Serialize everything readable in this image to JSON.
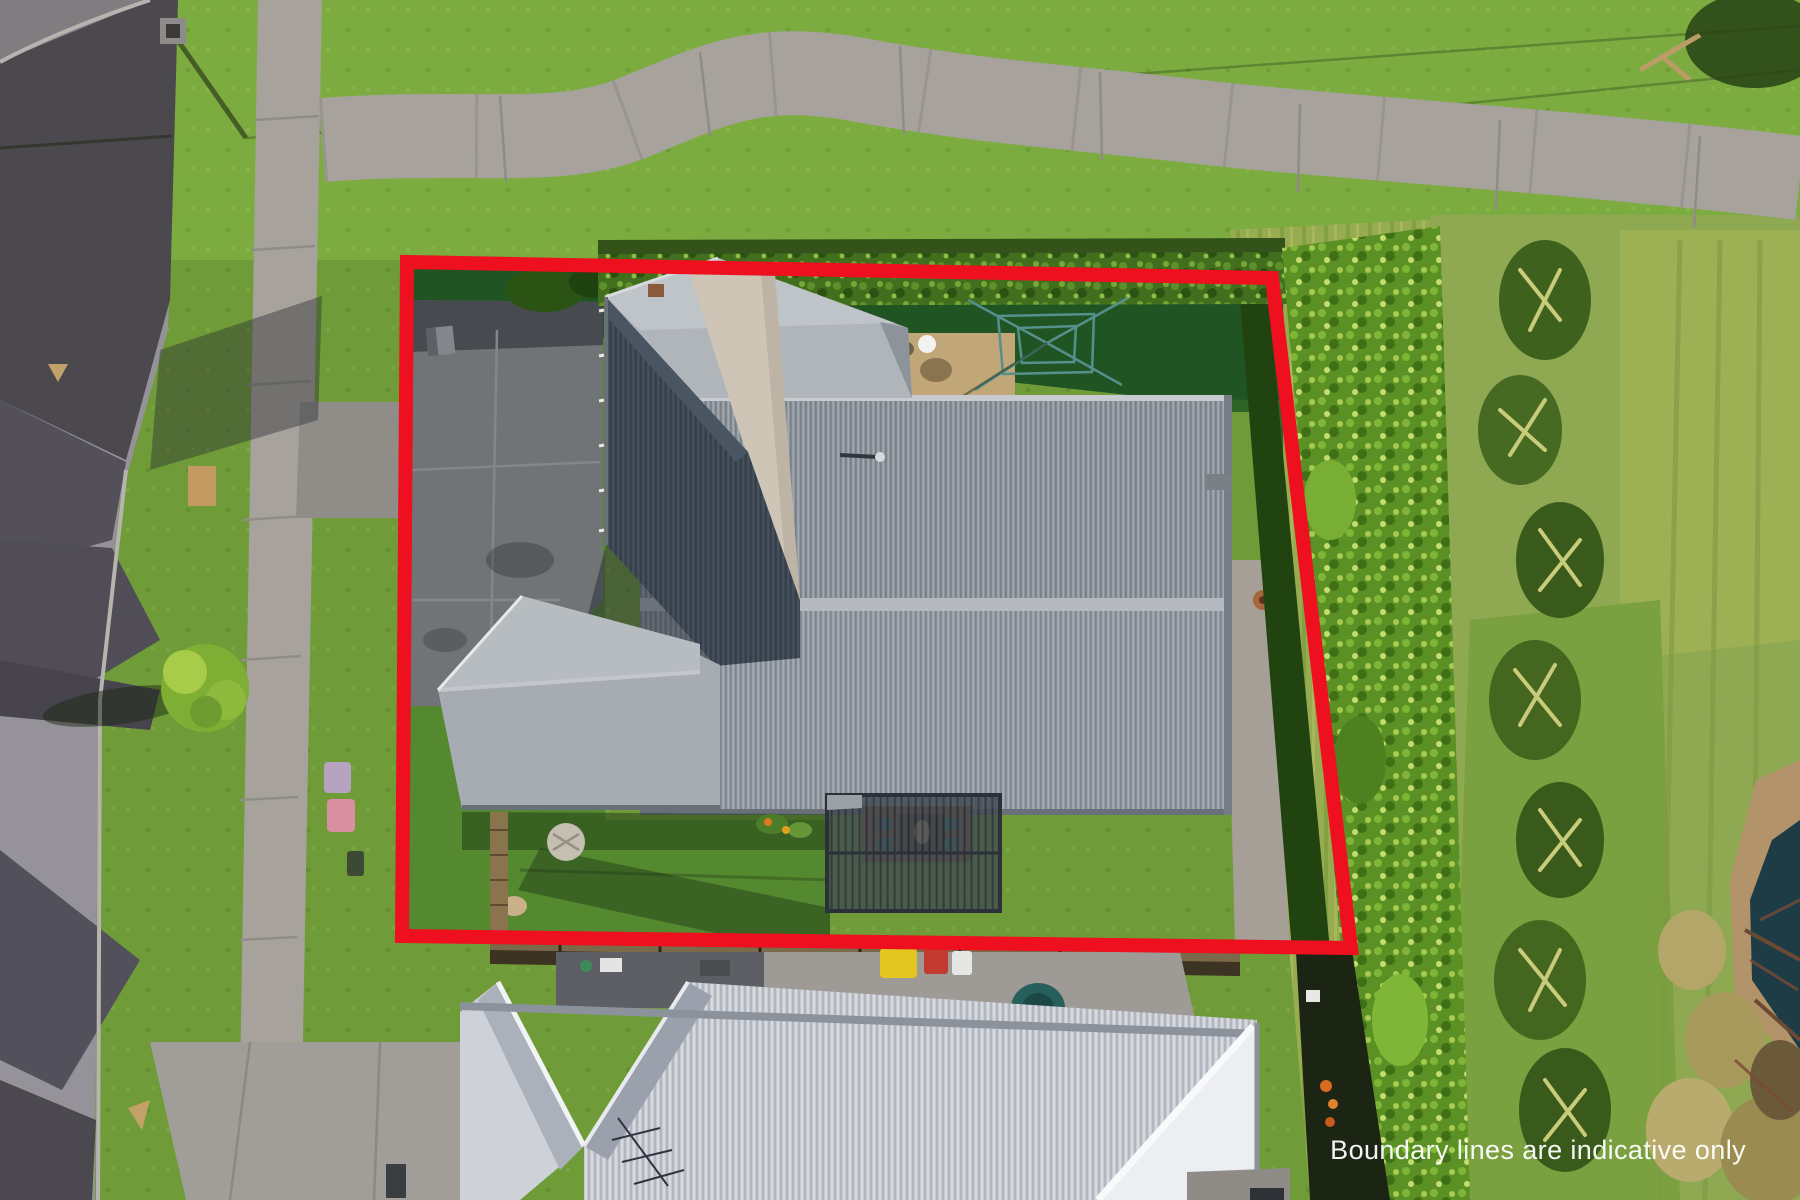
{
  "overlay": {
    "disclaimer_text": "Boundary lines are indicative only",
    "text_color": "#ffffff",
    "boundary": {
      "color": "#ee0f1f",
      "stroke_width": 14,
      "points": "407,262 1272,278 1351,948 402,936"
    }
  },
  "scene": {
    "type": "aerial-drone-photo-of-residential-property",
    "palette": {
      "grass_base": "#6f9c38",
      "grass_top_lawn": "#7cac40",
      "grass_shaded": "#235424",
      "grass_rough": "#97ab51",
      "road_dark": "#4b494d",
      "road_lit": "#96929a",
      "footpath": "#a7a29c",
      "driveway": "#717477",
      "main_roof": "#8e949c",
      "roof_ridge": "#b6bac0",
      "dark_roof_wing": "#3d4753",
      "cream_roof_band": "#cec5b6",
      "neighbor_roof": "#c6cad0",
      "neighbor_gable_white": "#eceef2",
      "hedge": "#416f1e",
      "hedge_right": "#5b9124",
      "flax": "#3f611e",
      "tussock": "#b3a668",
      "pond": "#1e3c45",
      "deck": "#7c5638",
      "pergola_slats": "#434b54",
      "fence_timber": "#8a744e",
      "bin_yellow": "#e3c61f",
      "bin_red": "#c23a32",
      "bin_pink": "#d98fa0",
      "tank_teal": "#275f5c"
    },
    "elements": [
      "street-asphalt-left",
      "side-street-top-left",
      "kerb-line",
      "grass-berm",
      "concrete-footpath",
      "winding-concrete-path",
      "street-tree",
      "wheelie-bins-berm",
      "utility-pole",
      "subject-property-driveway",
      "letterbox",
      "front-gable-roof",
      "main-hip-roof",
      "rear-roof-wing",
      "garage-gable-roof",
      "satellite-dish",
      "chimney-flue",
      "rotary-clothesline",
      "utility-pad",
      "backyard-lawn",
      "east-side-path",
      "terracotta-pot",
      "louvre-pergola",
      "timber-deck",
      "outdoor-table",
      "stepping-stone",
      "timber-fence-west",
      "timber-fence-south",
      "boundary-hedge-top",
      "boundary-hedge-right",
      "rough-grass-reserve",
      "flax-row",
      "tussock-grasses",
      "pond-edge",
      "neighbor-house-white-roof",
      "neighbor-garage-flat-roof",
      "tv-antenna",
      "wheelie-bins-yellow-red",
      "teal-tank",
      "neighbor-driveway",
      "house-shadows-on-road"
    ]
  }
}
